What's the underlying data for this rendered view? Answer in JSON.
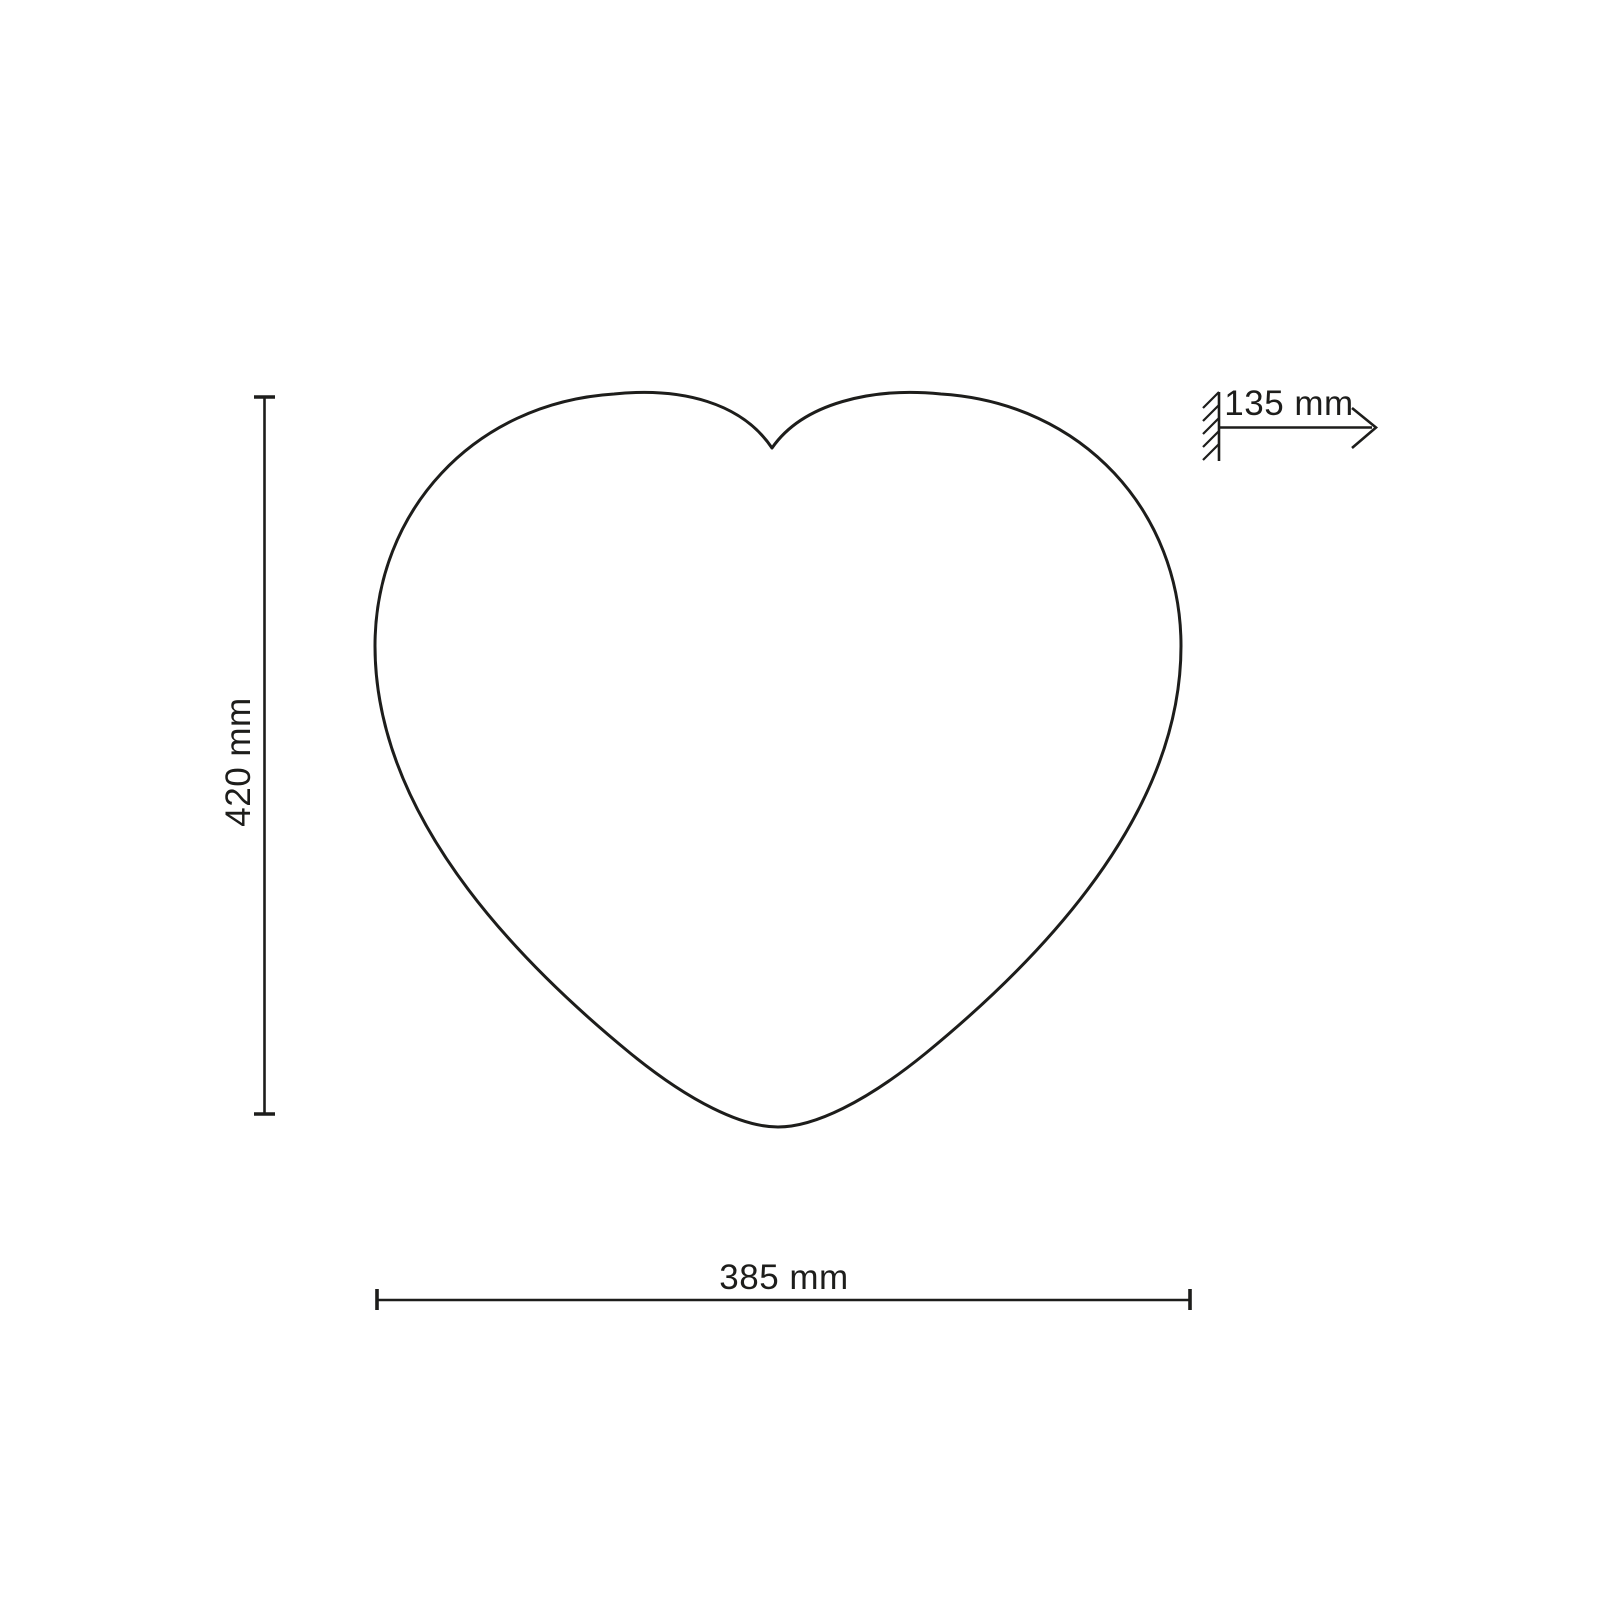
{
  "diagram": {
    "shape": "heart",
    "type": "technical-dimension-drawing",
    "labels": {
      "height": "420 mm",
      "width": "385 mm",
      "depth": "135 mm"
    },
    "colors": {
      "line": "#1d1d1b",
      "background": "#ffffff"
    }
  }
}
